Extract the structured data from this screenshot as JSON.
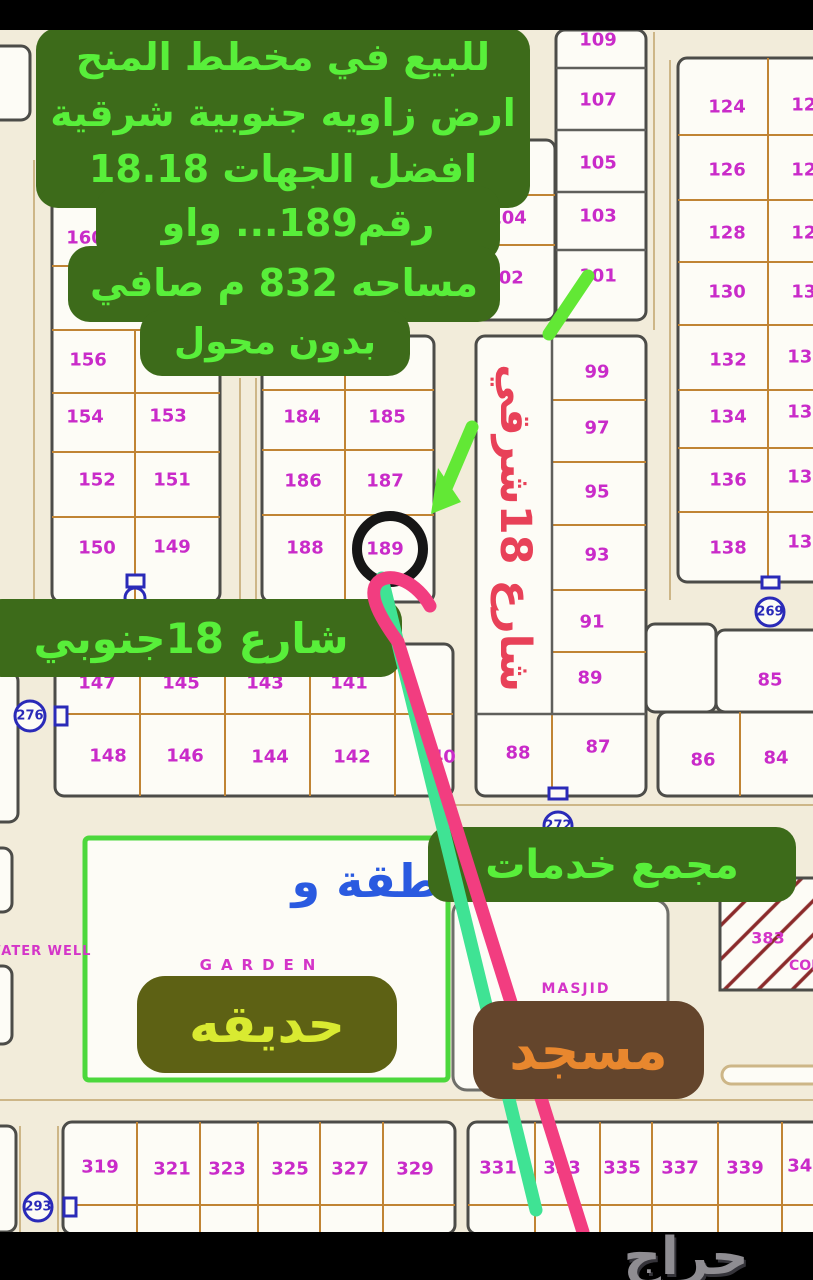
{
  "colors": {
    "cream": "#f2ecda",
    "block_fill": "#fdfcf6",
    "block_stroke": "#4c4c48",
    "block2_stroke": "#6f6f6a",
    "garden_stroke": "#4cd83c",
    "divider": "#c08434",
    "divider_dark": "#5f5f5b",
    "road": "#cdb687",
    "magenta": "#c92bc9",
    "blue": "#2a2ab8",
    "hatch": "#8b2b2b",
    "ring": "#161616",
    "green_line": "#3fe394",
    "pink_line": "#f23d80",
    "arrow_green": "#62e835"
  },
  "ad_overlay": {
    "bg": "#3d6b1a",
    "fg": "#58ef3a",
    "lines": [
      "للبيع في مخطط المنح",
      "ارض زاويه جنوبية شرقية",
      "افضل الجهات 18.18",
      "رقم189... واو",
      "مساحه 832 م صافي",
      "بدون محول"
    ],
    "blobs": [
      [
        36,
        28,
        494,
        180
      ],
      [
        96,
        186,
        404,
        76
      ],
      [
        68,
        246,
        432,
        76
      ],
      [
        140,
        310,
        270,
        66
      ]
    ],
    "line_pos": [
      [
        283,
        57,
        38
      ],
      [
        283,
        113,
        38
      ],
      [
        283,
        169,
        38
      ],
      [
        298,
        223,
        38
      ],
      [
        284,
        283,
        38
      ],
      [
        275,
        342,
        36
      ]
    ]
  },
  "labels": {
    "street_south": {
      "text": "شارع 18جنوبي",
      "x": -20,
      "y": 599,
      "w": 422,
      "h": 78,
      "fs": 42,
      "bg": "#3d6b1a",
      "fg": "#58ef3a",
      "r": 22
    },
    "street_east": {
      "text": "شارع 18شرقي",
      "x": 478,
      "y": 340,
      "w": 74,
      "h": 376,
      "fs": 43,
      "fg": "#e84158"
    },
    "services": {
      "text": "مجمع خدمات",
      "x": 428,
      "y": 827,
      "w": 368,
      "h": 75,
      "fs": 40,
      "bg": "#3d6b1a",
      "fg": "#58ef3a",
      "r": 20
    },
    "garden": {
      "text": "حديقه",
      "x": 137,
      "y": 976,
      "w": 260,
      "h": 97,
      "fs": 52,
      "bg": "#5d6114",
      "fg": "#d9ea31",
      "r": 28
    },
    "mosque": {
      "text": "مسجد",
      "x": 473,
      "y": 1001,
      "w": 231,
      "h": 98,
      "fs": 54,
      "bg": "#64452c",
      "fg": "#e8872e",
      "r": 28
    },
    "garden_en": {
      "text": "GARDEN",
      "cx": 262,
      "cy": 965,
      "fs": 15,
      "fg": "#d435c8",
      "ls": 9
    },
    "masjid_en": {
      "text": "MASJID",
      "cx": 576,
      "cy": 989,
      "fs": 14,
      "fg": "#d435c8",
      "ls": 2
    },
    "water_well": {
      "text": "WATER WELL",
      "x": -16,
      "y": 940,
      "w": 110,
      "h": 22,
      "fs": 13,
      "fg": "#d435c8",
      "ls": 1
    },
    "garden_note": {
      "text": "طقة و",
      "cx": 366,
      "cy": 881,
      "fs": 46,
      "fg": "#2a5ae0"
    },
    "logo": {
      "text": "حراج",
      "cx": 686,
      "cy": 1257,
      "fs": 52,
      "fg": "#8f8d92"
    }
  },
  "geometry": {
    "blocks": [
      {
        "x": -14,
        "y": 46,
        "w": 44,
        "h": 74,
        "s": "b"
      },
      {
        "x": 52,
        "y": 150,
        "w": 168,
        "h": 452,
        "s": "b"
      },
      {
        "x": 262,
        "y": 336,
        "w": 172,
        "h": 266,
        "s": "b"
      },
      {
        "x": 467,
        "y": 140,
        "w": 88,
        "h": 180,
        "s": "b"
      },
      {
        "x": 556,
        "y": 30,
        "w": 90,
        "h": 290,
        "s": "b"
      },
      {
        "x": 476,
        "y": 336,
        "w": 170,
        "h": 460,
        "s": "b"
      },
      {
        "x": 678,
        "y": 58,
        "w": 158,
        "h": 524,
        "s": "b"
      },
      {
        "x": 646,
        "y": 624,
        "w": 70,
        "h": 88,
        "s": "b"
      },
      {
        "x": 716,
        "y": 630,
        "w": 122,
        "h": 82,
        "s": "b"
      },
      {
        "x": 658,
        "y": 712,
        "w": 180,
        "h": 84,
        "s": "b"
      },
      {
        "x": 55,
        "y": 644,
        "w": 398,
        "h": 152,
        "s": "b"
      },
      {
        "x": 85,
        "y": 838,
        "w": 363,
        "h": 242,
        "s": "g"
      },
      {
        "x": 453,
        "y": 900,
        "w": 215,
        "h": 190,
        "s": "b2"
      },
      {
        "x": 63,
        "y": 1122,
        "w": 392,
        "h": 112,
        "s": "b"
      },
      {
        "x": 468,
        "y": 1122,
        "w": 368,
        "h": 112,
        "s": "b"
      },
      {
        "x": -16,
        "y": 1126,
        "w": 32,
        "h": 106,
        "s": "b"
      },
      {
        "x": -16,
        "y": 672,
        "w": 34,
        "h": 150,
        "s": "b"
      },
      {
        "x": -14,
        "y": 848,
        "w": 26,
        "h": 64,
        "s": "b"
      },
      {
        "x": -14,
        "y": 966,
        "w": 26,
        "h": 78,
        "s": "b"
      }
    ],
    "dividers": [
      [
        135,
        330,
        135,
        600
      ],
      [
        52,
        202,
        130,
        202
      ],
      [
        52,
        266,
        130,
        266
      ],
      [
        52,
        330,
        220,
        330
      ],
      [
        52,
        393,
        220,
        393
      ],
      [
        52,
        452,
        220,
        452
      ],
      [
        52,
        517,
        220,
        517
      ],
      [
        345,
        336,
        345,
        600
      ],
      [
        262,
        390,
        434,
        390
      ],
      [
        262,
        450,
        434,
        450
      ],
      [
        262,
        515,
        434,
        515
      ],
      [
        467,
        195,
        555,
        195
      ],
      [
        467,
        245,
        555,
        245
      ],
      [
        552,
        714,
        552,
        796
      ],
      [
        552,
        400,
        646,
        400
      ],
      [
        552,
        462,
        646,
        462
      ],
      [
        552,
        525,
        646,
        525
      ],
      [
        552,
        590,
        646,
        590
      ],
      [
        552,
        652,
        646,
        652
      ],
      [
        768,
        58,
        768,
        582
      ],
      [
        678,
        135,
        836,
        135
      ],
      [
        678,
        200,
        836,
        200
      ],
      [
        678,
        262,
        836,
        262
      ],
      [
        678,
        325,
        836,
        325
      ],
      [
        678,
        390,
        836,
        390
      ],
      [
        678,
        448,
        836,
        448
      ],
      [
        678,
        512,
        836,
        512
      ],
      [
        740,
        712,
        740,
        796
      ],
      [
        140,
        644,
        140,
        796
      ],
      [
        225,
        644,
        225,
        796
      ],
      [
        310,
        644,
        310,
        796
      ],
      [
        395,
        644,
        395,
        796
      ],
      [
        55,
        714,
        453,
        714
      ],
      [
        137,
        1122,
        137,
        1234
      ],
      [
        200,
        1122,
        200,
        1234
      ],
      [
        258,
        1122,
        258,
        1234
      ],
      [
        320,
        1122,
        320,
        1234
      ],
      [
        383,
        1122,
        383,
        1234
      ],
      [
        63,
        1205,
        455,
        1205
      ],
      [
        535,
        1122,
        535,
        1234
      ],
      [
        600,
        1122,
        600,
        1234
      ],
      [
        652,
        1122,
        652,
        1234
      ],
      [
        718,
        1122,
        718,
        1234
      ],
      [
        782,
        1122,
        782,
        1234
      ],
      [
        468,
        1205,
        836,
        1205
      ]
    ],
    "dividers_dark": [
      [
        556,
        68,
        646,
        68
      ],
      [
        556,
        130,
        646,
        130
      ],
      [
        556,
        192,
        646,
        192
      ],
      [
        556,
        250,
        646,
        250
      ],
      [
        552,
        336,
        552,
        714
      ],
      [
        476,
        714,
        646,
        714
      ]
    ],
    "roads": [
      [
        654,
        32,
        654,
        330
      ],
      [
        670,
        60,
        670,
        600
      ],
      [
        0,
        1100,
        813,
        1100
      ],
      [
        455,
        805,
        813,
        805
      ],
      [
        240,
        378,
        240,
        600
      ],
      [
        256,
        378,
        256,
        640
      ],
      [
        20,
        1126,
        20,
        1232
      ],
      [
        58,
        1126,
        58,
        1232
      ],
      [
        34,
        160,
        34,
        600
      ]
    ],
    "pill": [
      722,
      1066,
      104,
      18
    ],
    "hatch_block": [
      720,
      878,
      100,
      112
    ],
    "ring": {
      "cx": 390,
      "cy": 549,
      "r": 33,
      "w": 10
    }
  },
  "plots": [
    [
      "160",
      85,
      238
    ],
    [
      "156",
      88,
      360
    ],
    [
      "154",
      85,
      417
    ],
    [
      "153",
      168,
      416
    ],
    [
      "152",
      97,
      480
    ],
    [
      "151",
      172,
      480
    ],
    [
      "150",
      97,
      548
    ],
    [
      "149",
      172,
      547
    ],
    [
      "184",
      302,
      417
    ],
    [
      "185",
      387,
      417
    ],
    [
      "186",
      303,
      481
    ],
    [
      "187",
      385,
      481
    ],
    [
      "188",
      305,
      548
    ],
    [
      "189",
      385,
      549
    ],
    [
      "104",
      508,
      218
    ],
    [
      "102",
      505,
      278
    ],
    [
      "109",
      598,
      40
    ],
    [
      "107",
      598,
      100
    ],
    [
      "105",
      598,
      163
    ],
    [
      "103",
      598,
      216
    ],
    [
      "101",
      598,
      276
    ],
    [
      "99",
      597,
      372
    ],
    [
      "97",
      597,
      428
    ],
    [
      "95",
      597,
      492
    ],
    [
      "93",
      597,
      555
    ],
    [
      "91",
      592,
      622
    ],
    [
      "89",
      590,
      678
    ],
    [
      "88",
      518,
      753
    ],
    [
      "87",
      598,
      747
    ],
    [
      "124",
      727,
      107
    ],
    [
      "126",
      727,
      170
    ],
    [
      "128",
      727,
      233
    ],
    [
      "130",
      727,
      292
    ],
    [
      "132",
      728,
      360
    ],
    [
      "134",
      728,
      417
    ],
    [
      "136",
      728,
      480
    ],
    [
      "138",
      728,
      548
    ],
    [
      "125",
      810,
      105
    ],
    [
      "127",
      810,
      170
    ],
    [
      "129",
      810,
      233
    ],
    [
      "131",
      810,
      292
    ],
    [
      "133",
      806,
      357
    ],
    [
      "135",
      806,
      412
    ],
    [
      "137",
      806,
      477
    ],
    [
      "139",
      806,
      542
    ],
    [
      "85",
      770,
      680
    ],
    [
      "86",
      703,
      760
    ],
    [
      "84",
      776,
      758
    ],
    [
      "147",
      97,
      683
    ],
    [
      "145",
      181,
      683
    ],
    [
      "143",
      265,
      683
    ],
    [
      "141",
      349,
      683
    ],
    [
      "148",
      108,
      756
    ],
    [
      "146",
      185,
      756
    ],
    [
      "144",
      270,
      757
    ],
    [
      "142",
      352,
      757
    ],
    [
      "140",
      437,
      757
    ],
    [
      "319",
      100,
      1167
    ],
    [
      "321",
      172,
      1169
    ],
    [
      "323",
      227,
      1169
    ],
    [
      "325",
      290,
      1169
    ],
    [
      "327",
      350,
      1169
    ],
    [
      "329",
      415,
      1169
    ],
    [
      "331",
      498,
      1168
    ],
    [
      "333",
      562,
      1168
    ],
    [
      "335",
      622,
      1168
    ],
    [
      "337",
      680,
      1168
    ],
    [
      "339",
      745,
      1168
    ],
    [
      "341",
      806,
      1166
    ]
  ],
  "circles": [
    [
      "269",
      770,
      612,
      14
    ],
    [
      "276",
      30,
      716,
      15
    ],
    [
      "272",
      558,
      826,
      14
    ],
    [
      "293",
      38,
      1207,
      14
    ]
  ],
  "symbols": [
    [
      127,
      575,
      17,
      12
    ],
    [
      55,
      707,
      12,
      18
    ],
    [
      762,
      577,
      17,
      11
    ],
    [
      549,
      788,
      18,
      11
    ],
    [
      64,
      1198,
      12,
      18
    ]
  ],
  "symbol_circles": [
    [
      135,
      598,
      10
    ]
  ],
  "hatch_labels": [
    [
      "383",
      768,
      938,
      16
    ],
    [
      "COM",
      807,
      966,
      14
    ]
  ],
  "annotation": {
    "ring_note": "black circle marking plot 189",
    "strokes": [
      {
        "d": "M 588 276 L 549 334",
        "c": "arrow",
        "w": 13
      },
      {
        "d": "M 472 427 L 446 488",
        "c": "arrow",
        "w": 13
      },
      {
        "d": "M 382 578 L 536 1210",
        "c": "green",
        "w": 13
      },
      {
        "d": "M 430 606 C 418 584 392 570 378 582 C 366 594 382 620 398 642 L 583 1232",
        "c": "pink",
        "w": 13
      }
    ],
    "arrow_head": "431,514 461,502 438,468"
  }
}
